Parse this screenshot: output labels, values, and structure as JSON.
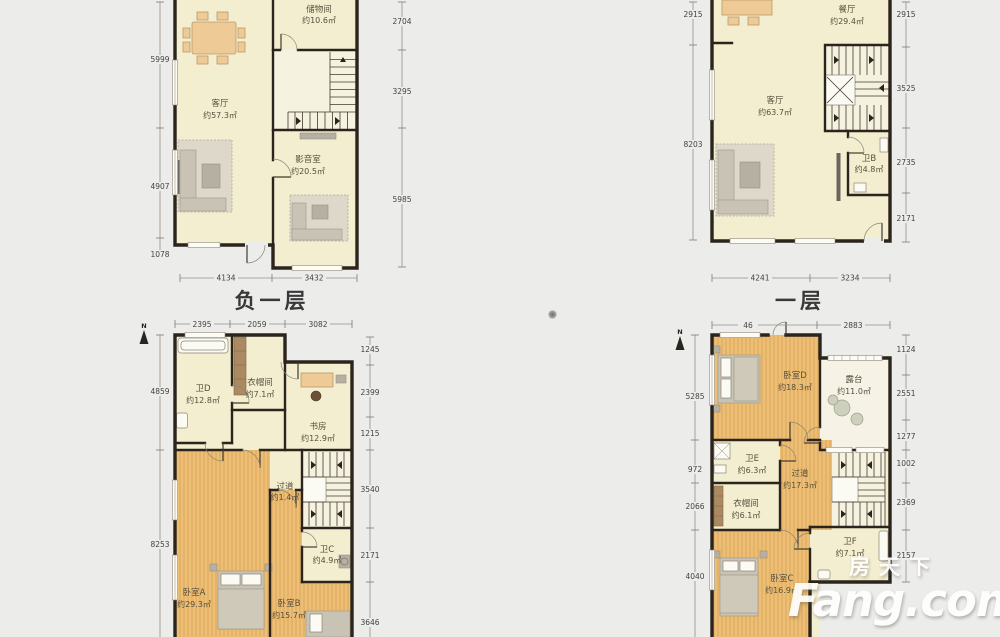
{
  "watermark": {
    "cn": "房天下",
    "en": "Fang.com"
  },
  "plans": {
    "p1": {
      "title": "负一层",
      "rooms": {
        "storage": {
          "name": "储物间",
          "area": "约10.6㎡"
        },
        "living": {
          "name": "客厅",
          "area": "约57.3㎡"
        },
        "media": {
          "name": "影音室",
          "area": "约20.5㎡"
        }
      },
      "dims": {
        "left": [
          "5999",
          "4907",
          "1078"
        ],
        "right": [
          "2704",
          "3295",
          "5985"
        ],
        "bottom": [
          "4134",
          "3432"
        ]
      }
    },
    "p2": {
      "title": "一层",
      "rooms": {
        "dining": {
          "name": "餐厅",
          "area": "约29.4㎡"
        },
        "living": {
          "name": "客厅",
          "area": "约63.7㎡"
        },
        "bath_b": {
          "name": "卫B",
          "area": "约4.8㎡"
        }
      },
      "dims": {
        "left": [
          "2915",
          "8203"
        ],
        "right": [
          "2915",
          "3525",
          "2735",
          "2171"
        ],
        "bottom": [
          "4241",
          "3234"
        ]
      }
    },
    "p3": {
      "north": "N",
      "rooms": {
        "bath_d": {
          "name": "卫D",
          "area": "约12.8㎡"
        },
        "cloak": {
          "name": "衣帽间",
          "area": "约7.1㎡"
        },
        "study": {
          "name": "书房",
          "area": "约12.9㎡"
        },
        "hall": {
          "name": "过道",
          "area": "约1.4㎡"
        },
        "bath_c": {
          "name": "卫C",
          "area": "约4.9㎡"
        },
        "bed_a": {
          "name": "卧室A",
          "area": "约29.3㎡"
        },
        "bed_b": {
          "name": "卧室B",
          "area": "约15.7㎡"
        }
      },
      "dims": {
        "top": [
          "2395",
          "2059",
          "3082"
        ],
        "left": [
          "4859",
          "8253"
        ],
        "right": [
          "1245",
          "2399",
          "1215",
          "3540",
          "2171",
          "3646"
        ]
      }
    },
    "p4": {
      "north": "N",
      "rooms": {
        "bed_d": {
          "name": "卧室D",
          "area": "约18.3㎡"
        },
        "terrace": {
          "name": "露台",
          "area": "约11.0㎡"
        },
        "bath_e": {
          "name": "卫E",
          "area": "约6.3㎡"
        },
        "hall": {
          "name": "过道",
          "area": "约17.3㎡"
        },
        "cloak": {
          "name": "衣帽间",
          "area": "约6.1㎡"
        },
        "bath_f": {
          "name": "卫F",
          "area": "约7.1㎡"
        },
        "bed_c": {
          "name": "卧室C",
          "area": "约16.9㎡"
        }
      },
      "dims": {
        "top": [
          "46",
          "2883"
        ],
        "left": [
          "5285",
          "972",
          "2066",
          "4040"
        ],
        "right": [
          "1124",
          "2551",
          "1277",
          "1002",
          "2369",
          "2157"
        ]
      }
    }
  }
}
